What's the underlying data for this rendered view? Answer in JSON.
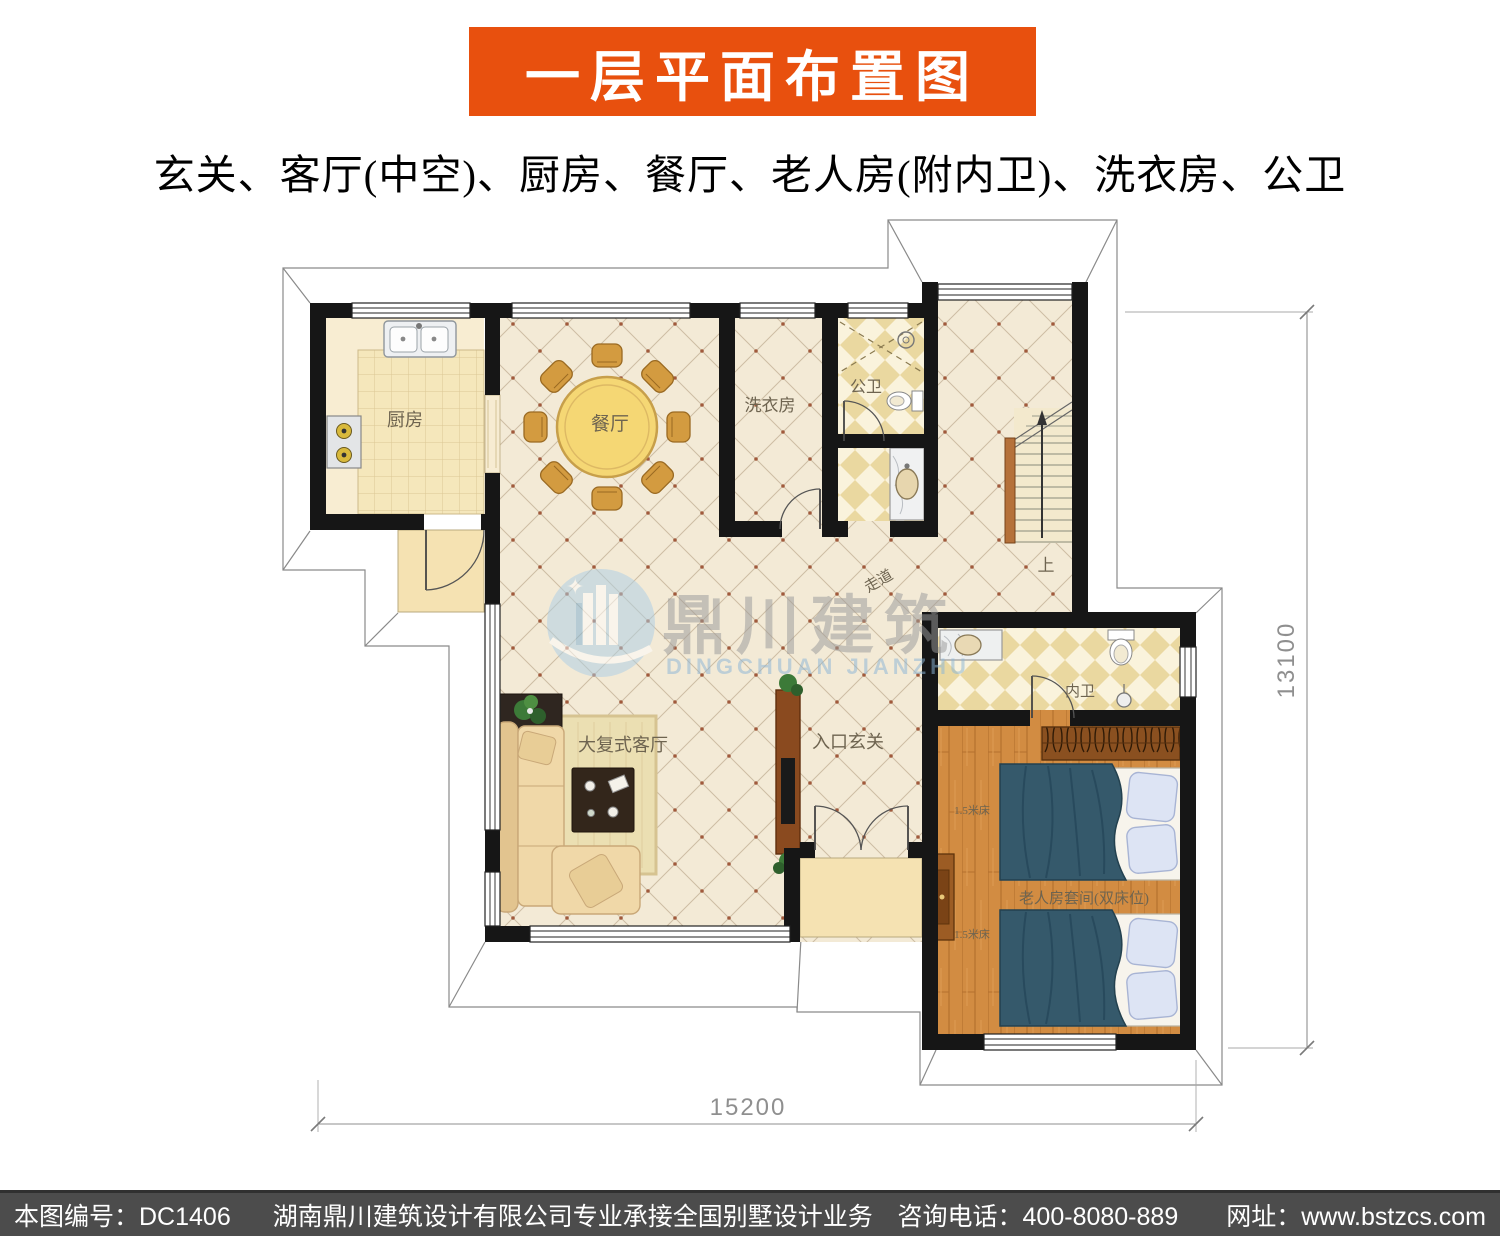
{
  "theme": {
    "banner_bg": "#e8500e",
    "footer_bg": "#4c4c4c",
    "wall": "#161616",
    "tile_floor": "#f3ead6",
    "tile_line": "#cdbda4",
    "tile_dot": "#a05a3c",
    "kitchen_tile": "#f5e7bb",
    "wood_floor": "#d28c42",
    "checker": "#ead8a0",
    "porch": "#f5e2b2",
    "watermark_blue": "#8cb6d6",
    "watermark_gray": "#9b9b9b",
    "dim_color": "#8f8f8f",
    "label_color": "#6e6450"
  },
  "header": {
    "title": "一层平面布置图",
    "subtitle": "玄关、客厅(中空)、厨房、餐厅、老人房(附内卫)、洗衣房、公卫"
  },
  "plan": {
    "rooms": {
      "kitchen": "厨房",
      "dining": "餐厅",
      "laundry": "洗衣房",
      "public_bath": "公卫",
      "corridor": "走道",
      "stairs_up": "上",
      "living": "大复式客厅",
      "entry": "入口玄关",
      "inner_bath": "内卫",
      "elder_room": "老人房套间(双床位)",
      "bed_label_1": "1.5米床",
      "bed_label_2": "1.5米床"
    },
    "dimensions": {
      "width_mm": "15200",
      "height_mm": "13100"
    }
  },
  "watermark": {
    "cn": "鼎川建筑",
    "en": "DINGCHUAN JIANZHU"
  },
  "footer": {
    "code": "本图编号：DC1406",
    "company": "湖南鼎川建筑设计有限公司专业承接全国别墅设计业务",
    "phone": "咨询电话：400-8080-889",
    "website": "网址：www.bstzcs.com"
  }
}
